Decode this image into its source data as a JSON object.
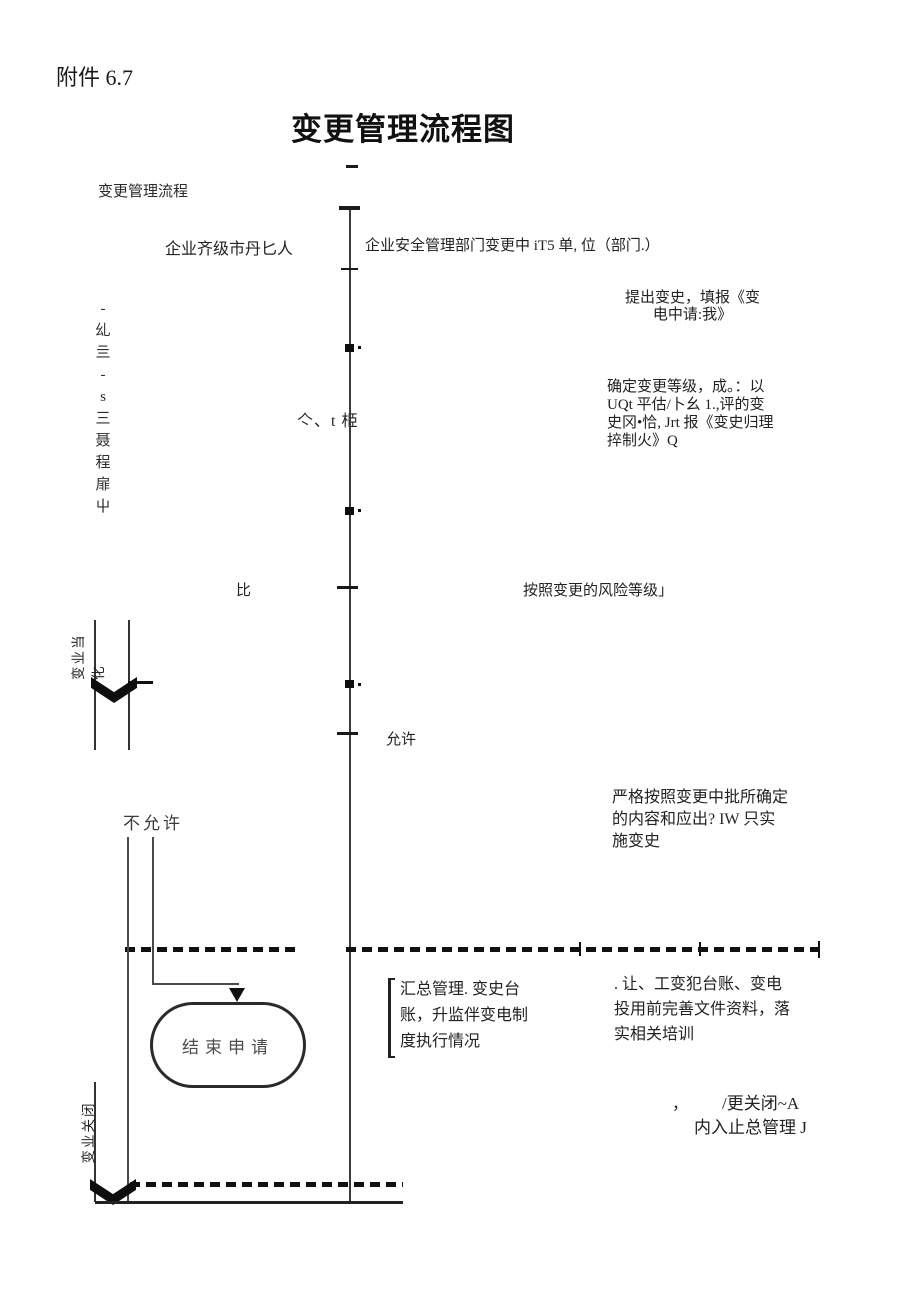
{
  "doc": {
    "attachment": "附件 6.7",
    "title": "变更管理流程图",
    "caption": "变更管理流程"
  },
  "lanes": {
    "left_header": "企业齐级市丹匕人",
    "right_header": "企业安全管理部门变更中 iT5 单, 位（部门.）"
  },
  "margin_column": [
    "-",
    "乣",
    "亖",
    "-",
    "s",
    "三",
    "聂",
    "程",
    "扉",
    "屮"
  ],
  "stray_glyphs": "亽、t 栕",
  "nodes": {
    "propose": [
      "提出变史，填报《变",
      "电中请:我》"
    ],
    "grade": [
      "确定变更等级，成。：以",
      "UQt 平估/卜幺 1.,评的变",
      "史冈•恰, Jrt 报《变史归理",
      "捽制火》Q"
    ],
    "risk": "按照变更的风险等级」",
    "compare": "比",
    "allow": "允许",
    "deny": "不允许",
    "implement": [
      "严格按照变更中批所确定",
      "的内容和应出? IW 只实",
      "施变史"
    ],
    "summary": [
      "汇总管理. 变史台",
      "账，升监伴变电制",
      "度执行情况"
    ],
    "improve": [
      ". 让、工变犯台账、变电",
      "投用前完善文件资料，落",
      "实相关培训"
    ],
    "terminator": "结束申请",
    "close_note_comma": "，",
    "close_note_line1": "/更关闭~A",
    "close_note_line2": "内入止总管理 J"
  },
  "banners": {
    "approval": "变业当化",
    "close": "变业关闭"
  }
}
